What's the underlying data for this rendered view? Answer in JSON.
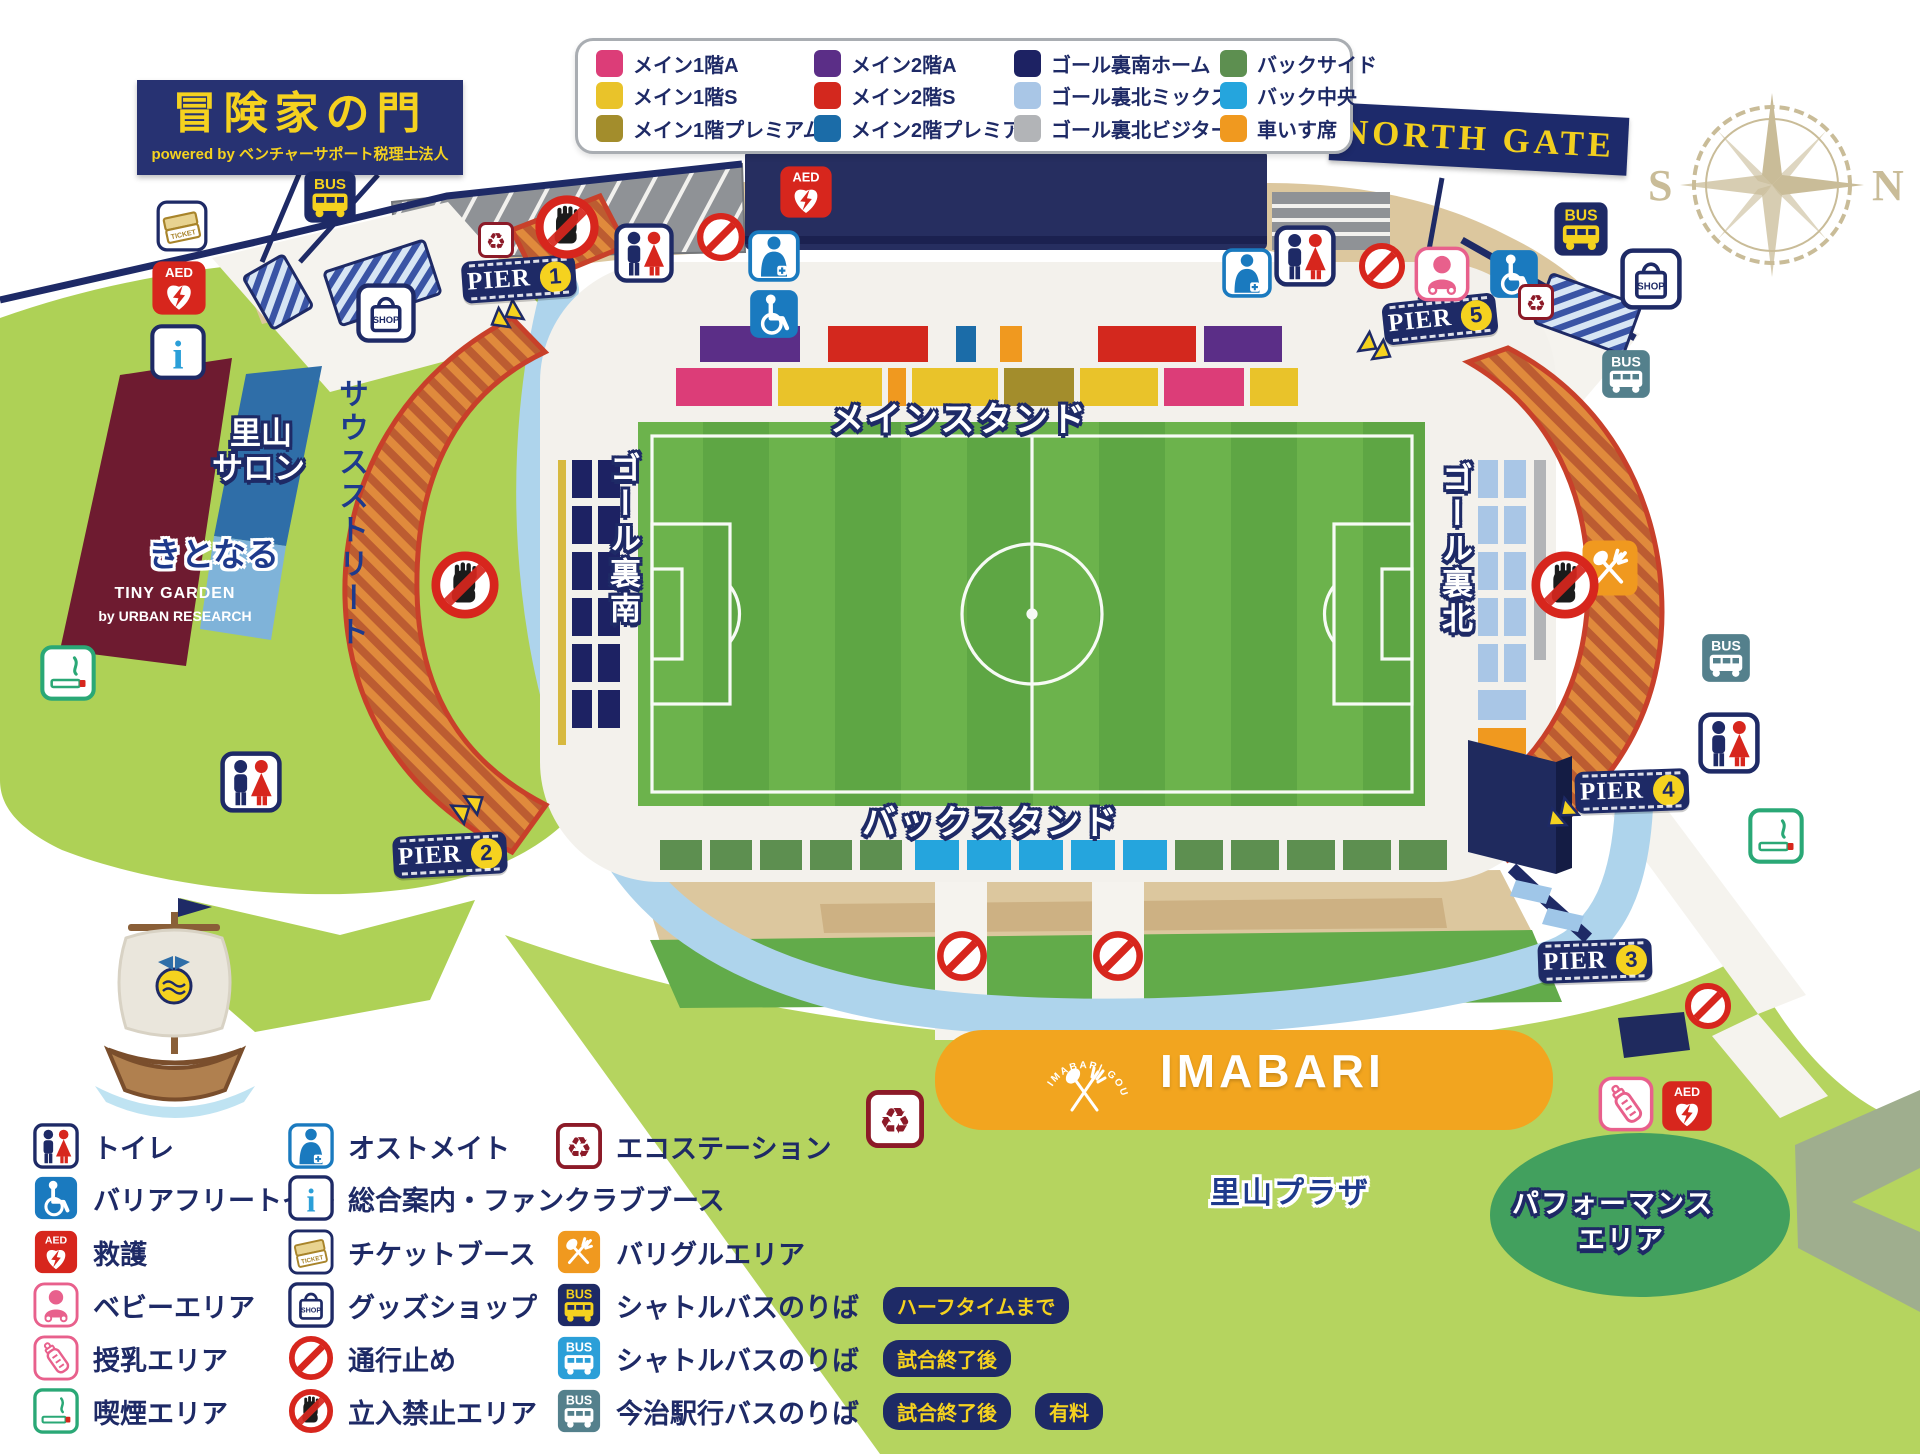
{
  "banner": {
    "title": "冒険家の門",
    "subtitle": "powered by ベンチャーサポート税理士法人"
  },
  "north_gate_label": "NORTH GATE",
  "compass": {
    "s": "S",
    "n": "N"
  },
  "seat_legend": {
    "items": [
      {
        "label": "メイン1階A",
        "color": "#dc3d78"
      },
      {
        "label": "メイン2階A",
        "color": "#5b2e87"
      },
      {
        "label": "ゴール裏南ホーム",
        "color": "#1d2263"
      },
      {
        "label": "バックサイド",
        "color": "#5d8f50"
      },
      {
        "label": "メイン1階S",
        "color": "#e9c32a"
      },
      {
        "label": "メイン2階S",
        "color": "#d3281e"
      },
      {
        "label": "ゴール裏北ミックス",
        "color": "#a9c6e6"
      },
      {
        "label": "バック中央",
        "color": "#25a5dd"
      },
      {
        "label": "メイン1階プレミアム",
        "color": "#a38d2c"
      },
      {
        "label": "メイン2階プレミアム",
        "color": "#1b6ca8"
      },
      {
        "label": "ゴール裏北ビジター",
        "color": "#b2b4b7"
      },
      {
        "label": "車いす席",
        "color": "#f0991f"
      }
    ]
  },
  "piers": [
    {
      "label": "PIER",
      "number": "1"
    },
    {
      "label": "PIER",
      "number": "2"
    },
    {
      "label": "PIER",
      "number": "3"
    },
    {
      "label": "PIER",
      "number": "4"
    },
    {
      "label": "PIER",
      "number": "5"
    }
  ],
  "stand_labels": {
    "main_stand": "メインスタンド",
    "back_stand": "バックスタンド",
    "goal_south": "ゴール裏南",
    "goal_north": "ゴール裏北"
  },
  "area_labels": {
    "south_street": "サウスストリート",
    "satoyama_salon_1": "里山",
    "satoyama_salon_2": "サロン",
    "kitonaru": "きとなる",
    "tiny_garden_1": "TINY GARDEN",
    "tiny_garden_2": "by URBAN RESEARCH",
    "imabari": "IMABARI",
    "gourmet_arc": "IMABARI GOURMET",
    "satoyama_plaza": "里山プラザ",
    "performance_1": "パフォーマンス",
    "performance_2": "エリア"
  },
  "icons": {
    "aed_label": "AED",
    "bus_label": "BUS",
    "shop_label": "SHOP",
    "ticket_label": "TICKET",
    "info_glyph": "i",
    "recycle_glyph": "♻"
  },
  "facility_legend": {
    "col1": [
      {
        "icon": "toilet-icon",
        "label": "トイレ"
      },
      {
        "icon": "barrier-free-toilet-icon",
        "label": "バリアフリートイレ"
      },
      {
        "icon": "first-aid-aed-icon",
        "label": "救護"
      },
      {
        "icon": "baby-area-icon",
        "label": "ベビーエリア"
      },
      {
        "icon": "nursing-icon",
        "label": "授乳エリア"
      },
      {
        "icon": "smoking-icon",
        "label": "喫煙エリア"
      }
    ],
    "col2": [
      {
        "icon": "ostomate-icon",
        "label": "オストメイト"
      },
      {
        "icon": "info-icon",
        "label": "総合案内・ファンクラブブース"
      },
      {
        "icon": "ticket-booth-icon",
        "label": "チケットブース"
      },
      {
        "icon": "goods-shop-icon",
        "label": "グッズショップ"
      },
      {
        "icon": "no-entry-icon",
        "label": "通行止め"
      },
      {
        "icon": "keep-out-icon",
        "label": "立入禁止エリア"
      }
    ],
    "col3": [
      {
        "icon": "eco-station-icon",
        "label": "エコステーション"
      },
      {
        "icon": "bariguru-icon",
        "label": "バリグルエリア"
      },
      {
        "icon": "shuttle-bus-yellow-icon",
        "label": "シャトルバスのりば",
        "badge1": "ハーフタイムまで"
      },
      {
        "icon": "shuttle-bus-blue-icon",
        "label": "シャトルバスのりば",
        "badge1": "試合終了後"
      },
      {
        "icon": "imabari-sta-bus-icon",
        "label": "今治駅行バスのりば",
        "badge1": "試合終了後",
        "badge2": "有料"
      }
    ]
  },
  "colors": {
    "navy": "#1e2a66",
    "red": "#d7261d",
    "pink_icon": "#e87f9c",
    "green_icon": "#2aa876",
    "blue_icon": "#1a7abf",
    "pitch_green_a": "#6cb34c",
    "pitch_green_b": "#5ea644",
    "map_green": "#b5d45f",
    "sand": "#dcc79e",
    "river": "#aed4ec",
    "orange_area": "#f2a51f",
    "gold": "#f5d21f"
  }
}
